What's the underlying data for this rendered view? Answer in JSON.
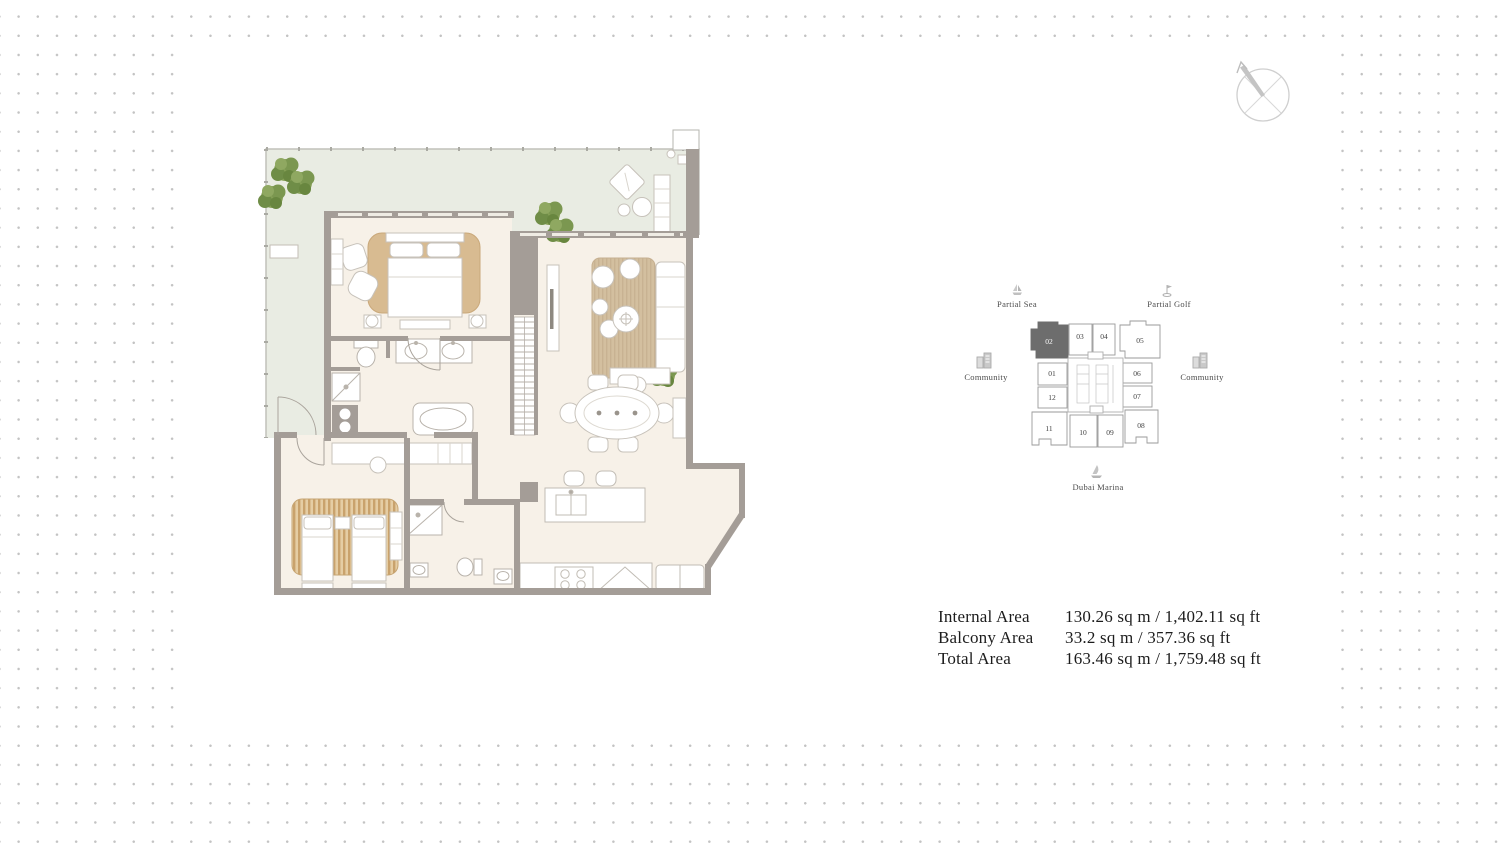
{
  "area_table": {
    "rows": [
      {
        "label": "Internal Area",
        "value": "130.26 sq m / 1,402.11 sq ft"
      },
      {
        "label": "Balcony Area",
        "value": "33.2 sq m / 357.36 sq ft"
      },
      {
        "label": "Total Area",
        "value": "163.46 sq m / 1,759.48 sq ft"
      }
    ]
  },
  "key_plan": {
    "highlight_color": "#6d6d6d",
    "highlighted_unit": "02",
    "units": [
      {
        "label": "02",
        "highlighted": true
      },
      {
        "label": "03",
        "highlighted": false
      },
      {
        "label": "04",
        "highlighted": false
      },
      {
        "label": "05",
        "highlighted": false
      },
      {
        "label": "01",
        "highlighted": false
      },
      {
        "label": "12",
        "highlighted": false
      },
      {
        "label": "06",
        "highlighted": false
      },
      {
        "label": "07",
        "highlighted": false
      },
      {
        "label": "11",
        "highlighted": false
      },
      {
        "label": "10",
        "highlighted": false
      },
      {
        "label": "09",
        "highlighted": false
      },
      {
        "label": "08",
        "highlighted": false
      }
    ],
    "pois": [
      {
        "icon": "sailboat-icon",
        "label": "Partial Sea"
      },
      {
        "icon": "golf-flag-icon",
        "label": "Partial Golf"
      },
      {
        "icon": "buildings-icon",
        "label": "Community"
      },
      {
        "icon": "buildings-icon",
        "label": "Community"
      },
      {
        "icon": "boat-icon",
        "label": "Dubai Marina"
      }
    ]
  },
  "floor_plan": {
    "colors": {
      "walls": "#a49d97",
      "balcony_floor": "#e9ece3",
      "interior_floor": "#f7f1e8",
      "rug": "#d8bb91",
      "plants": "#7d9a4f"
    }
  }
}
